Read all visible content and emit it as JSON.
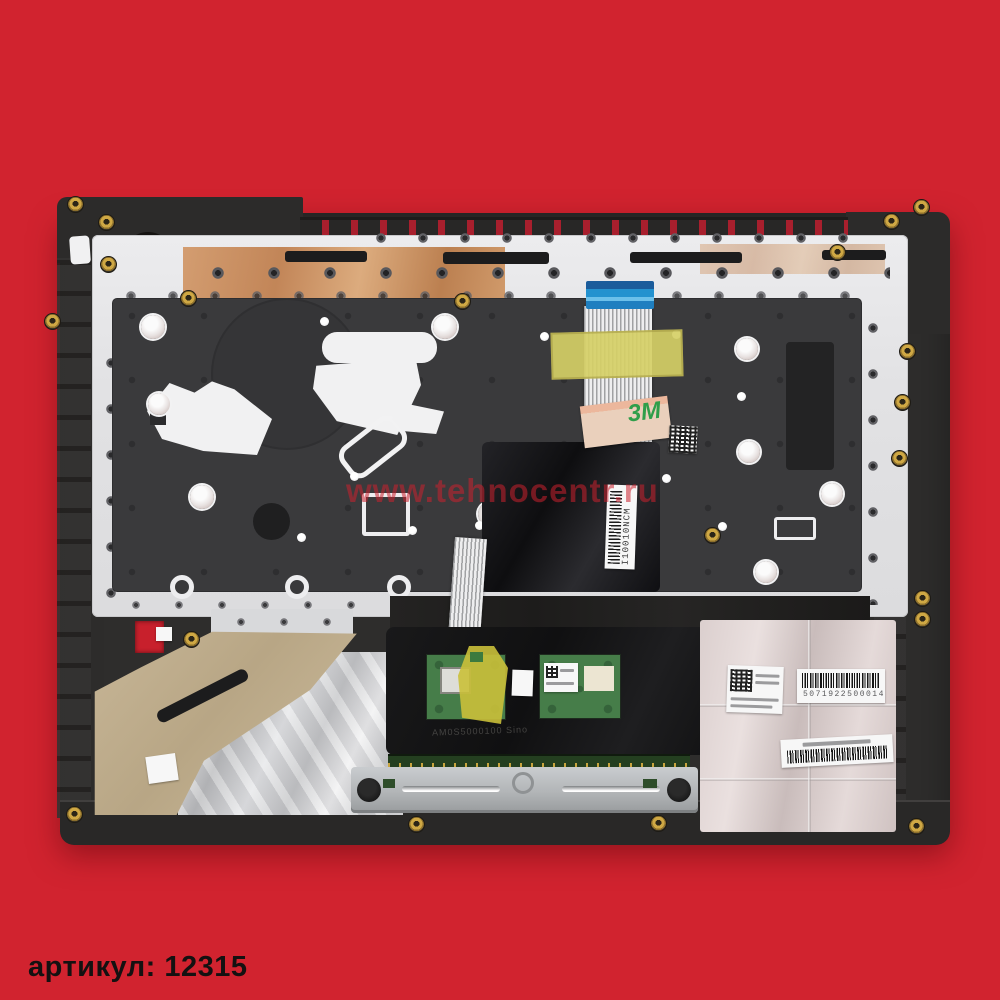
{
  "photo": {
    "description": "Laptop palmrest top case (internal side) with keyboard plate, touchpad module, foil shielding and service labels, photographed on a red background",
    "background_color": "#d1232f"
  },
  "page": {
    "caption": "артикул: 12315"
  },
  "watermark": {
    "text": "www.tehnocentr.ru",
    "color": "rgba(203,33,46,0.55)"
  },
  "labels": {
    "keyboard_cable_barcode": "I10010NCM",
    "foil_barcode_number": "5071922500014",
    "tape_3m": "3M",
    "touchpad_embossed": "AM0S5000100 Sino"
  },
  "colors": {
    "red_background": "#d1232f",
    "dark_plastic": "#2e2d2c",
    "keyboard_plate_silver": "#e6e6e8",
    "copper_foil": "#c98d5f",
    "membrane_gray": "#3a3a3c",
    "connector_blue": "#2492cf",
    "kapton_yellow": "#d5cf66",
    "pcb_green": "#467d49",
    "foil_pink_silver": "#d9cdcc",
    "tan_tape": "#bfae92",
    "gold_screw": "#cfa844"
  }
}
